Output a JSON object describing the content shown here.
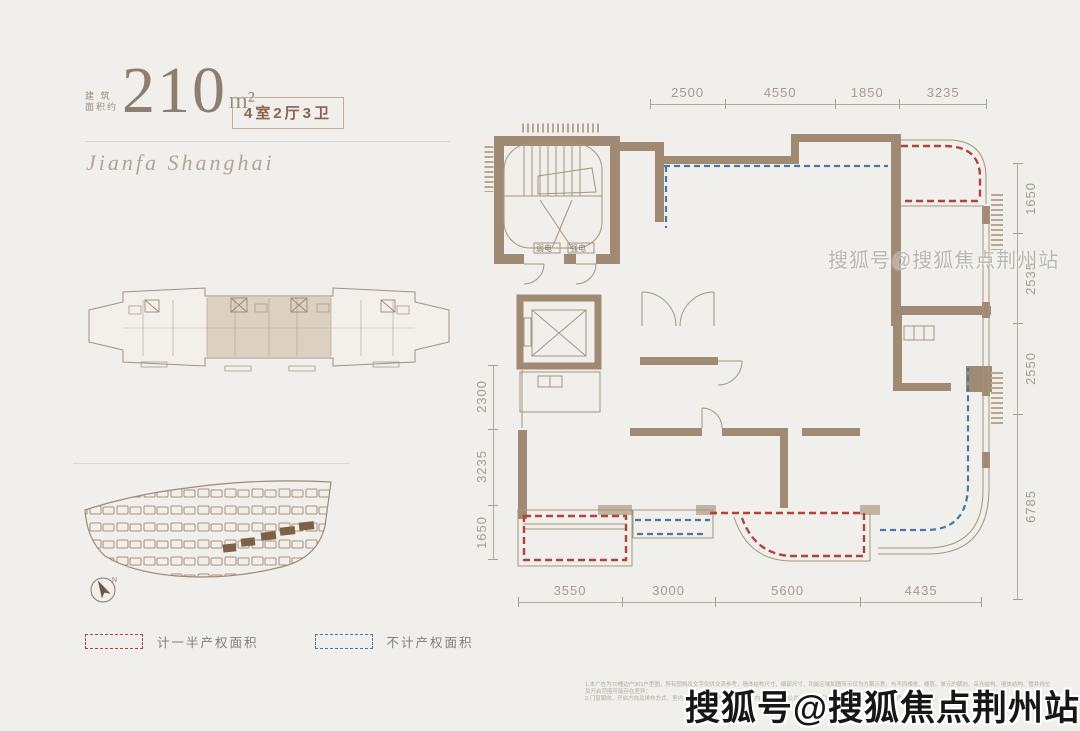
{
  "page": {
    "background": "#f1efeb"
  },
  "header": {
    "area_label_line1": "建 筑",
    "area_label_line2": "面积约",
    "area_value": "210",
    "area_unit": "m²",
    "unit_layout_badge": "4室2厅3卫",
    "brand_script": "Jianfa Shanghai"
  },
  "floor_plan": {
    "room_labels": {
      "weak_electric": "弱电",
      "strong_electric": "强电"
    },
    "dimensions_mm": {
      "top": [
        2500,
        4550,
        1850,
        3235
      ],
      "right": [
        1650,
        2535,
        2550,
        6785
      ],
      "left": [
        2300,
        3235,
        1650
      ],
      "bottom": [
        3550,
        3000,
        5600,
        4435
      ]
    },
    "colors": {
      "wall": "#a18a73",
      "wall_light": "#c3b3a0",
      "outline": "#a3957f",
      "half_property_red": "#b0433a",
      "excluded_blue": "#4a76a4",
      "dimension_text": "#a59b8e"
    }
  },
  "legend": {
    "half_property": {
      "label": "计一半产权面积",
      "color": "#b0433a"
    },
    "excluded": {
      "label": "不计产权面积",
      "color": "#4a76a4"
    }
  },
  "site_plan": {
    "north_label": "N"
  },
  "watermarks": {
    "inline_text": "搜狐号@搜狐焦点荆州站",
    "footer_text": "搜狐号@搜狐焦点荆州站"
  },
  "disclaimer": {
    "line1": "1.本广告为70幢边户301户型图，所有图档及文字仅供交流参考，墙体结构尺寸、细部尺寸、功能区域如图所示仅为方案示意，与不同楼栋、楼层、单元的朝向、采光结构、墙体结构、管井线位及开启范围可能存在差异；",
    "line2": "2.门窗朝向、开启方向及排布方式、室内设备管道、管井及空调位置、内隔墙配置、公共部位均以实际交付为准；4.具体详见商品房买卖合同约定。"
  }
}
